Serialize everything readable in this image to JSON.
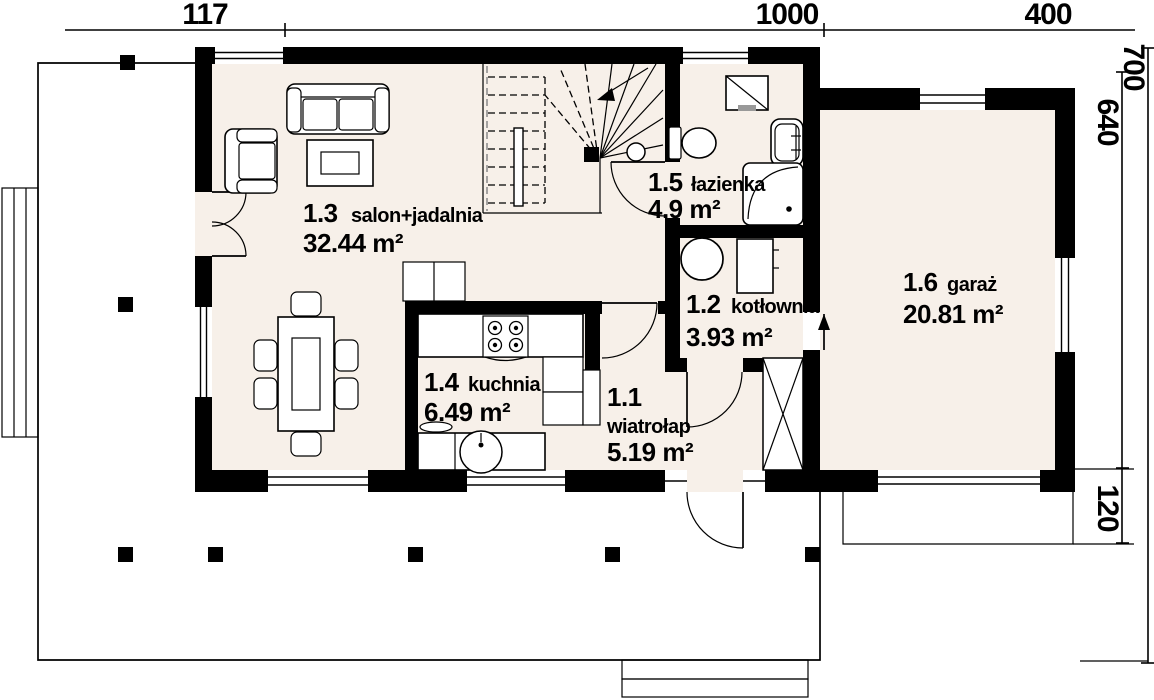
{
  "dimensions": {
    "top": [
      "117",
      "1000",
      "400"
    ],
    "right": [
      "700",
      "640",
      "120"
    ]
  },
  "rooms": [
    {
      "number": "1.1",
      "name": "wiatrołap",
      "area": "5.19 m²"
    },
    {
      "number": "1.2",
      "name": "kotłownia",
      "area": "3.93 m²"
    },
    {
      "number": "1.3",
      "name": "salon+jadalnia",
      "area": "32.44 m²"
    },
    {
      "number": "1.4",
      "name": "kuchnia",
      "area": "6.49 m²"
    },
    {
      "number": "1.5",
      "name": "łazienka",
      "area": "4.9 m²"
    },
    {
      "number": "1.6",
      "name": "garaż",
      "area": "20.81 m²"
    }
  ],
  "colors": {
    "floor": "#f7f0e9",
    "wall": "#000000",
    "line": "#000000",
    "background": "#ffffff",
    "appliance_accent": "#999999"
  }
}
